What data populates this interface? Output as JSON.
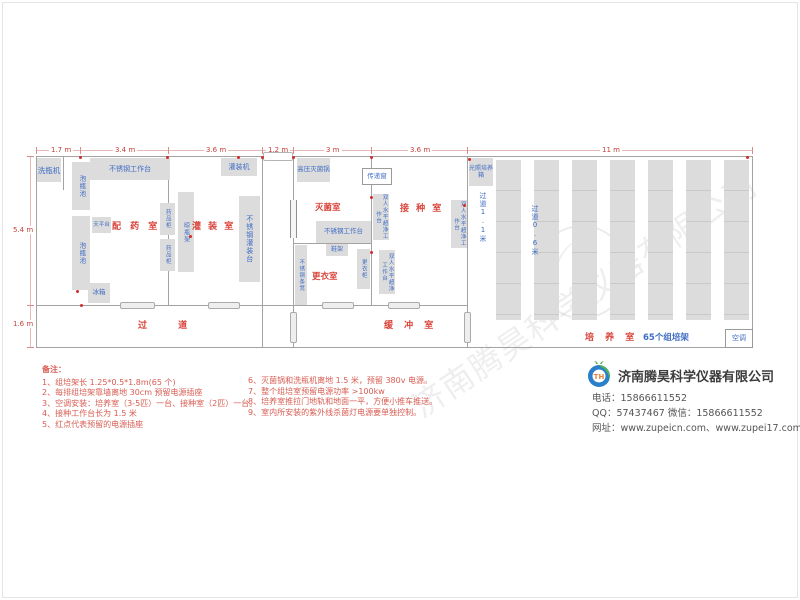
{
  "dims": {
    "top": [
      "1.7 m",
      "3.4 m",
      "3.6 m",
      "1.2 m",
      "3 m",
      "3.6 m",
      "11 m"
    ],
    "left": [
      "5.4 m",
      "1.6 m"
    ]
  },
  "rooms": {
    "prep": "配 药 室",
    "filling": "灌 装 室",
    "sterilize": "灭菌室",
    "inoculation": "接 种 室",
    "changing": "更衣室",
    "corridor": "过 道",
    "buffer": "缓 冲 室",
    "culture": "培 养 室",
    "culture_racks": "65个组培架",
    "aisle_wide": "过道1.1米",
    "aisle_narrow": "过道0.6米"
  },
  "equipment": {
    "bottle_washer": "洗瓶机",
    "soak_pool": "泡瓶池",
    "ss_workbench": "不锈钢工作台",
    "balance_table": "天平台",
    "fridge": "冰箱",
    "medicine_cabinet": "药品柜",
    "bottle_rack": "晾瓶架",
    "filling_machine": "灌装机",
    "ss_filling_table": "不锈钢灌装台",
    "autoclave": "高压灭菌锅",
    "transfer_window": "传递窗",
    "clean_bench": "双人水平超净工作台",
    "shoe_rack": "鞋架",
    "locker": "更衣柜",
    "ss_bench": "不锈钢条凳",
    "light_incubator": "光照培养箱",
    "air_conditioner": "空调"
  },
  "notes": {
    "title": "备注：",
    "col1": [
      "1、组培架长 1.25*0.5*1.8m(65 个)",
      "2、每排组培架靠墙离地 30cm 预留电源插座",
      "3、空调安装：培养室（3-5匹）一台、接种室（2匹）一台。",
      "4、接种工作台长为 1.5 米",
      "5、红点代表预留的电源插座"
    ],
    "col2": [
      "6、灭菌锅和洗瓶机离地 1.5 米，预留 380v 电源。",
      "7、整个组培室预留电源功率 >100kw",
      "8、培养室推拉门地轨和地面一平，方便小推车推送。",
      "9、室内所安装的紫外线杀菌灯电源要单独控制。"
    ]
  },
  "company": {
    "name": "济南腾昊科学仪器有限公司",
    "phone": "电话：15866611552",
    "qq_wechat": "QQ：57437467  微信：15866611552",
    "web": "网址：www.zupeicn.com、www.zupei17.com",
    "logo_text": "TH"
  },
  "watermark": "济南腾昊科学仪器有限公司",
  "colors": {
    "room_label": "#d9453c",
    "equipment_label": "#3f6dc4",
    "dimension": "#c4413a",
    "logo_blue": "#2a7fc9",
    "logo_green": "#55b54e"
  }
}
